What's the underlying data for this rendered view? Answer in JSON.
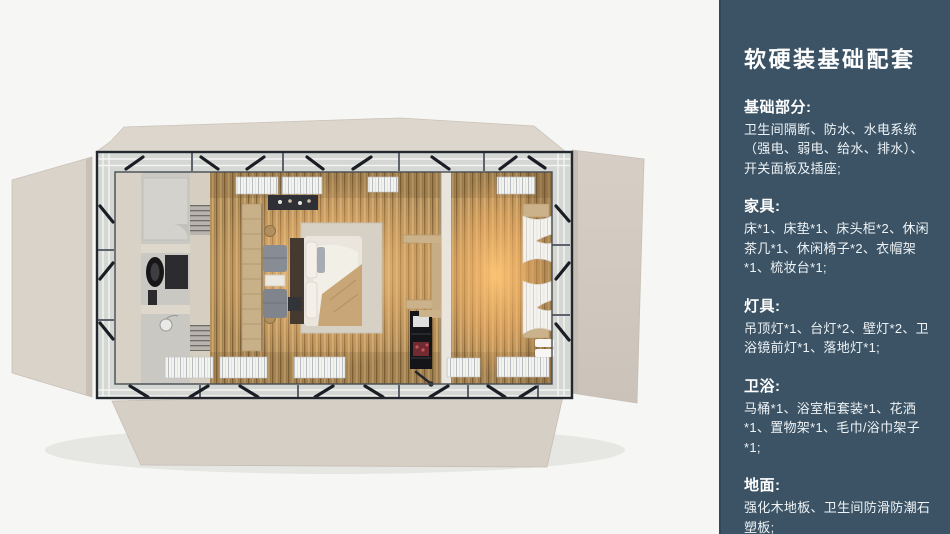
{
  "panel": {
    "title": "软硬装基础配套",
    "bg_color": "#3b5365",
    "text_color": "#ffffff",
    "sections": [
      {
        "heading": "基础部分:",
        "body": "卫生间隔断、防水、水电系统（强电、弱电、给水、排水）、开关面板及插座;"
      },
      {
        "heading": "家具:",
        "body": "床*1、床垫*1、床头柜*2、休闲茶几*1、休闲椅子*2、衣帽架*1、梳妆台*1;"
      },
      {
        "heading": "灯具:",
        "body": "吊顶灯*1、台灯*2、壁灯*2、卫浴镜前灯*1、落地灯*1;"
      },
      {
        "heading": "卫浴:",
        "body": "马桶*1、浴室柜套装*1、花洒*1、置物架*1、毛巾/浴巾架子*1;"
      },
      {
        "heading": "地面:",
        "body": "强化木地板、卫生间防滑防潮石塑板;"
      }
    ]
  },
  "floorplan": {
    "alt": "集装箱客房顶视渲染图：左侧卫生间（马桶、浴室柜、花洒），中部双人床与休闲椅茶几，右侧暖光房间带窗帘与百叶窗",
    "colors": {
      "flap_beige": "#d8d1c8",
      "frame_dark": "#23272e",
      "wood_floor": "#b3905c",
      "warm_glow": "#f0c488",
      "bathroom_gray": "#c9c8c2",
      "bedding_white": "#ebe6dd"
    }
  }
}
